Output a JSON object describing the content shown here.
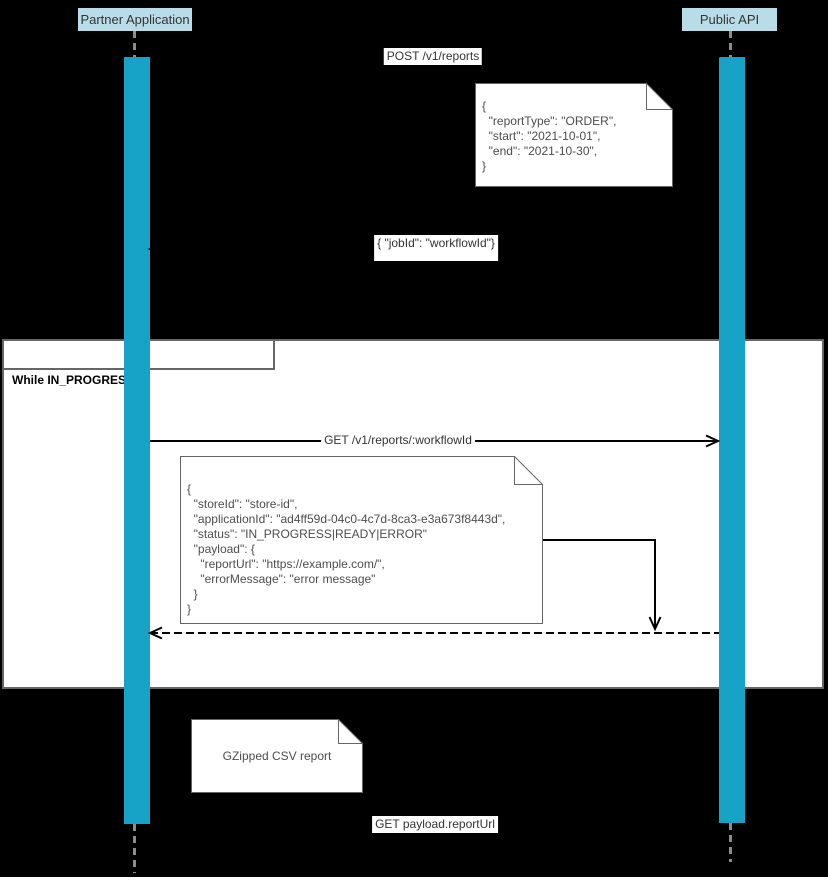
{
  "colors": {
    "canvas-bg": "#000000",
    "frame-bg": "#ffffff",
    "frame-border": "#666666",
    "activation": "#17a2c8",
    "participant-bg": "#b8dde9",
    "participant-text": "#333333",
    "lifeline": "#8c8c8c",
    "note-border": "#666666",
    "note-text": "#4d4d4d",
    "message-line": "#000000",
    "message-text": "#333333"
  },
  "participants": [
    {
      "label": "Partner Application"
    },
    {
      "label": "Public API"
    }
  ],
  "loop": {
    "label": "While IN_PROGRESS"
  },
  "messages": [
    {
      "label": "POST /v1/reports"
    },
    {
      "label": "{ \"jobId\": \"workflowId\"}"
    },
    {
      "label": "GET /v1/reports/:workflowId"
    },
    {
      "label": "GET payload.reportUrl"
    }
  ],
  "notes": [
    {
      "text": "{\n  \"reportType\": \"ORDER\",\n  \"start\": \"2021-10-01\",\n  \"end\": \"2021-10-30\",\n}"
    },
    {
      "text": "{\n  \"storeId\": \"store-id\",\n  \"applicationId\": \"ad4ff59d-04c0-4c7d-8ca3-e3a673f8443d\",\n  \"status\": \"IN_PROGRESS|READY|ERROR\"\n  \"payload\": {\n    \"reportUrl\": \"https://example.com/\",\n    \"errorMessage\": \"error message\"\n  }\n}"
    },
    {
      "text": "GZipped CSV report"
    }
  ]
}
